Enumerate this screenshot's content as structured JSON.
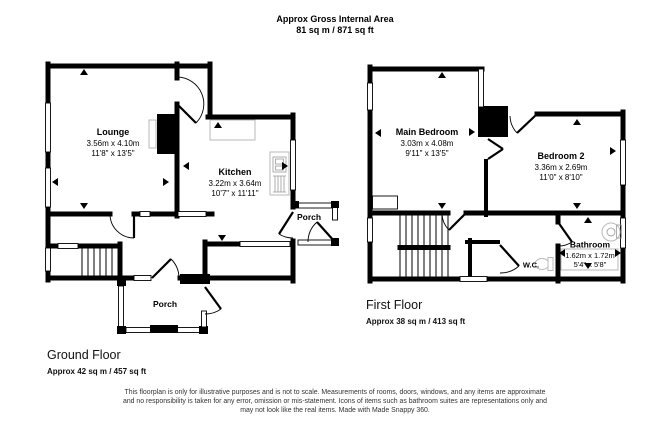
{
  "header": {
    "line1": "Approx Gross Internal Area",
    "line2": "81 sq m / 871 sq ft"
  },
  "ground_floor": {
    "title": "Ground Floor",
    "area": "Approx 42 sq m / 457 sq ft",
    "rooms": {
      "lounge": {
        "name": "Lounge",
        "metric": "3.56m x 4.10m",
        "imperial": "11'8\" x 13'5\""
      },
      "kitchen": {
        "name": "Kitchen",
        "metric": "3.22m x 3.64m",
        "imperial": "10'7\" x 11'11\""
      },
      "porch_side": {
        "name": "Porch"
      },
      "porch_front": {
        "name": "Porch"
      }
    }
  },
  "first_floor": {
    "title": "First Floor",
    "area": "Approx 38 sq m / 413 sq ft",
    "rooms": {
      "main_bedroom": {
        "name": "Main Bedroom",
        "metric": "3.03m x 4.08m",
        "imperial": "9'11\" x 13'5\""
      },
      "bedroom2": {
        "name": "Bedroom 2",
        "metric": "3.36m x 2.69m",
        "imperial": "11'0\" x 8'10\""
      },
      "bathroom": {
        "name": "Bathroom",
        "metric": "1.62m x 1.72m",
        "imperial": "5'4\" x 5'8\""
      },
      "wc": {
        "name": "W.C."
      }
    }
  },
  "disclaimer": {
    "line1": "This floorplan is only for illustrative purposes and is not to scale. Measurements of rooms, doors, windows, and any items are approximate",
    "line2": "and no responsibility is taken for any error, omission or mis-statement. Icons of items such as bathroom suites are representations only and",
    "line3": "may not look like the real items. Made with Made Snappy 360."
  },
  "colors": {
    "wall": "#000000",
    "fixture_outline": "#b9b9b9",
    "background": "#ffffff"
  }
}
